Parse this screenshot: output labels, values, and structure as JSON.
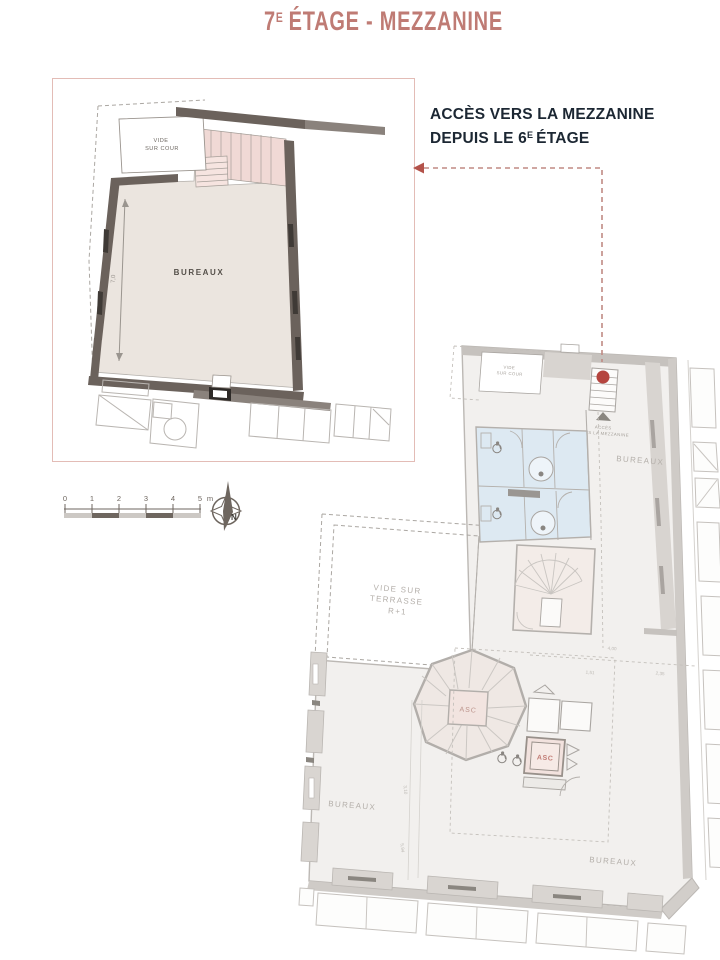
{
  "title": {
    "floor_number": "7",
    "superscript": "E",
    "text": "ÉTAGE - MEZZANINE"
  },
  "annotation": {
    "line1": "ACCÈS VERS LA MEZZANINE",
    "line2_prefix": "DEPUIS LE 6",
    "line2_superscript": "E",
    "line2_suffix": "ÉTAGE"
  },
  "detail_plan": {
    "void_label_line1": "VIDE",
    "void_label_line2": "SUR COUR",
    "room_label": "BUREAUX",
    "dimension": "7,0"
  },
  "scale_bar": {
    "ticks": [
      "0",
      "1",
      "2",
      "3",
      "4",
      "5"
    ],
    "unit": "m"
  },
  "compass": {
    "north": "N"
  },
  "main_plan": {
    "void_cour_line1": "VIDE",
    "void_cour_line2": "SUR COUR",
    "access_line1": "ACCÈS",
    "access_line2": "VERS LA MEZZANINE",
    "bureaux_corridor": "BUREAUX",
    "terrace_line1": "VIDE SUR",
    "terrace_line2": "TERRASSE",
    "terrace_line3": "R+1",
    "stair_elevator": "ASC",
    "elevator": "ASC",
    "bureaux_left": "BUREAUX",
    "bureaux_bottom": "BUREAUX",
    "dim_a": "4,00",
    "dim_b": "2,35",
    "dim_c": "1,51",
    "dim_d": "3,10",
    "dim_e": "5,94"
  },
  "colors": {
    "accent_salmon": "#bf7b74",
    "arrow_dash": "#c08a84",
    "arrow_head": "#b3524a",
    "red_marker": "#b5443e",
    "wall_dark": "#6b625c",
    "floor_beige": "#ebe5df",
    "stair_pink": "#f0d9d5",
    "wc_blue": "#dde9f2",
    "faded_gray": "#b5b0ab",
    "annotation_text": "#1c2733"
  }
}
